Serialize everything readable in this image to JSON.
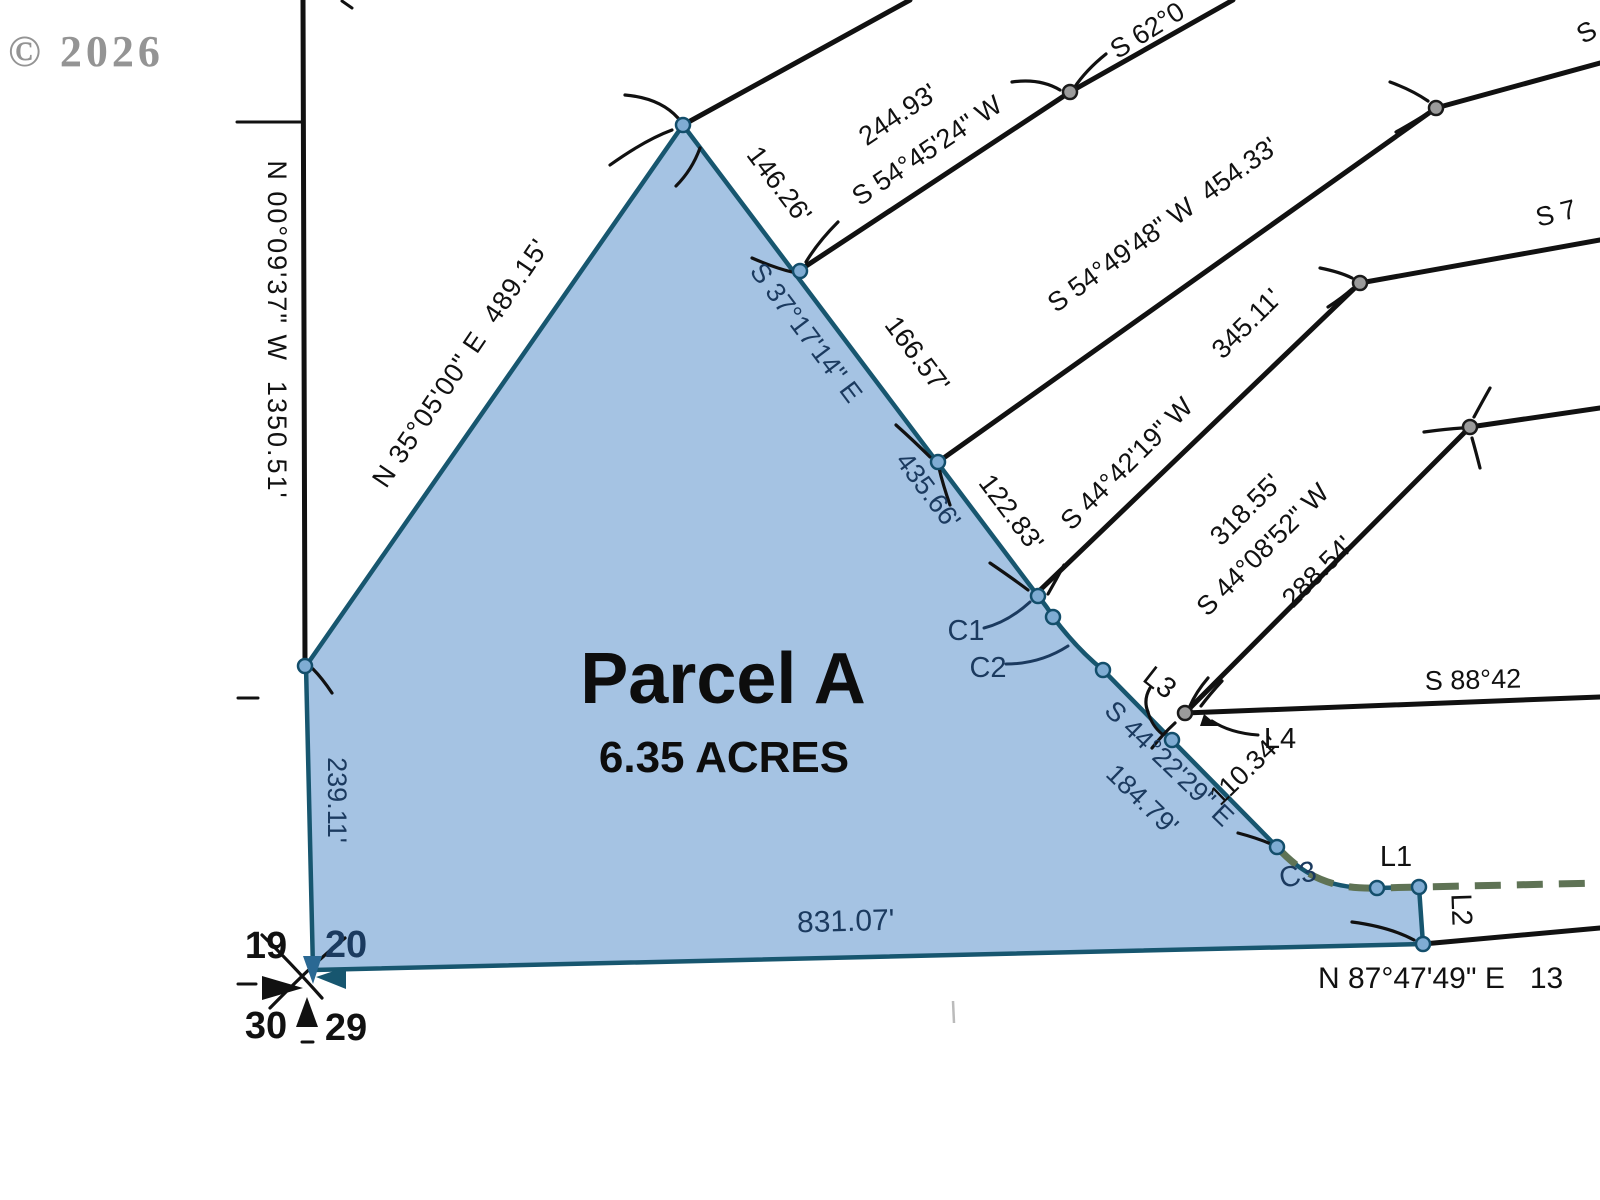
{
  "colors": {
    "parcel_fill": "#a5c3e3",
    "parcel_stroke": "#17566f",
    "navy_text": "#1b3a5f",
    "line_black": "#111111",
    "dashed_green": "#5f7355",
    "copyright_gray": "#949494"
  },
  "copyright": "© 2026",
  "parcel": {
    "name": "Parcel A",
    "area": "6.35 ACRES",
    "edge_bearing_upper": "S 37°17'14\" E",
    "edge_length_upper": "435.66'",
    "edge_bearing_lower": "S 44°22'29\" E",
    "edge_length_lower": "184.79'",
    "west_length": "239.11'",
    "south_length": "831.07'",
    "curves": {
      "c1": "C1",
      "c2": "C2",
      "c3": "C3"
    },
    "lines": {
      "l1": "L1",
      "l2": "L2",
      "l3": "L3",
      "l4": "L4"
    }
  },
  "section_line_label": "N 00°09'37\" W  1350.51'",
  "nw_edge_label": "N 35°05'00\" E  489.15'",
  "adjoiners": {
    "seg1": "146.26'",
    "seg2": "166.57'",
    "seg3": "122.83'",
    "line_244_dist": "244.93'",
    "line_244_bearing": "S 54°45'24\" W",
    "line_62": "S 62°0",
    "line_454": "S 54°49'48\" W  454.33'",
    "line_345_bearing": "S 44°42'19\" W",
    "line_345_dist": "345.11'",
    "line_s7": "S 7",
    "line_s_top": "S",
    "dist_318": "318.55'",
    "bearing_4408": "S 44°08'52\" W",
    "dist_288": "288.54'",
    "line_s88": "S 88°42",
    "dist_110": "110.34'",
    "south_line_label": "N 87°47'49\" E   13"
  },
  "section_corner": {
    "nw": "19",
    "ne": "20",
    "sw": "30",
    "se": "29"
  }
}
